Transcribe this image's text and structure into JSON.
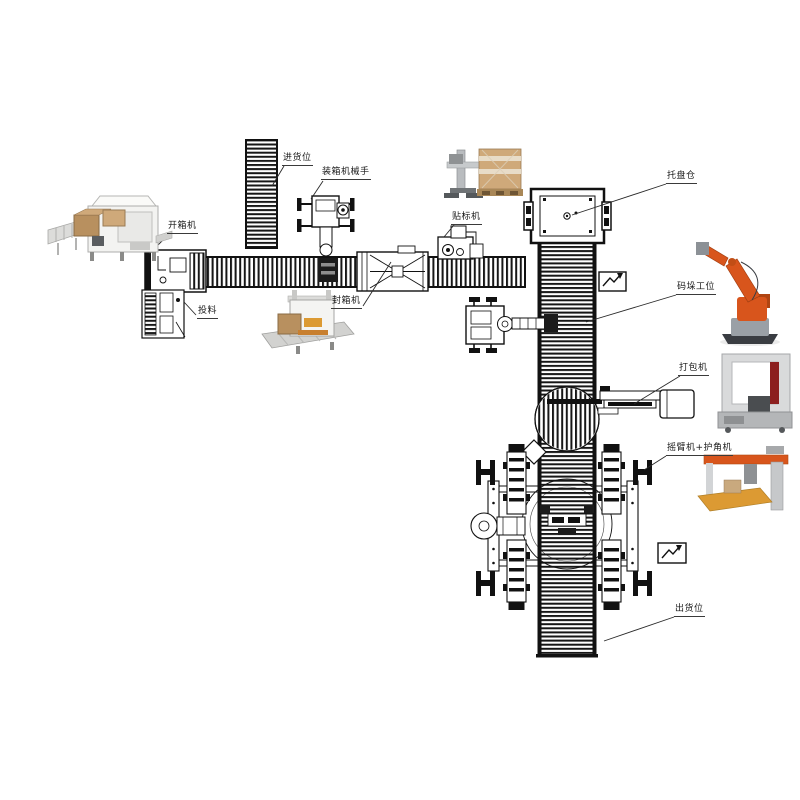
{
  "diagram": {
    "labels": {
      "infeed_position": "进货位",
      "case_packing_robot": "装箱机械手",
      "case_erector": "开箱机",
      "feeding": "投料",
      "case_sealer": "封箱机",
      "labeling_machine": "贴标机",
      "pallet_magazine": "托盘仓",
      "palletizing_station": "码垛工位",
      "strapping_machine": "打包机",
      "arm_wrapper_corner": "摇臂机+护角机",
      "outfeed_position": "出货位"
    },
    "colors": {
      "line": "#1a1a1a",
      "robot_orange": "#d8551c",
      "carton_brown": "#b8905f",
      "carton_light": "#cfa97a",
      "machine_gray": "#d9dadb",
      "dark_gray": "#4a4d50",
      "red_accent": "#8c1f1f",
      "platform_orange": "#dc9a33"
    }
  }
}
